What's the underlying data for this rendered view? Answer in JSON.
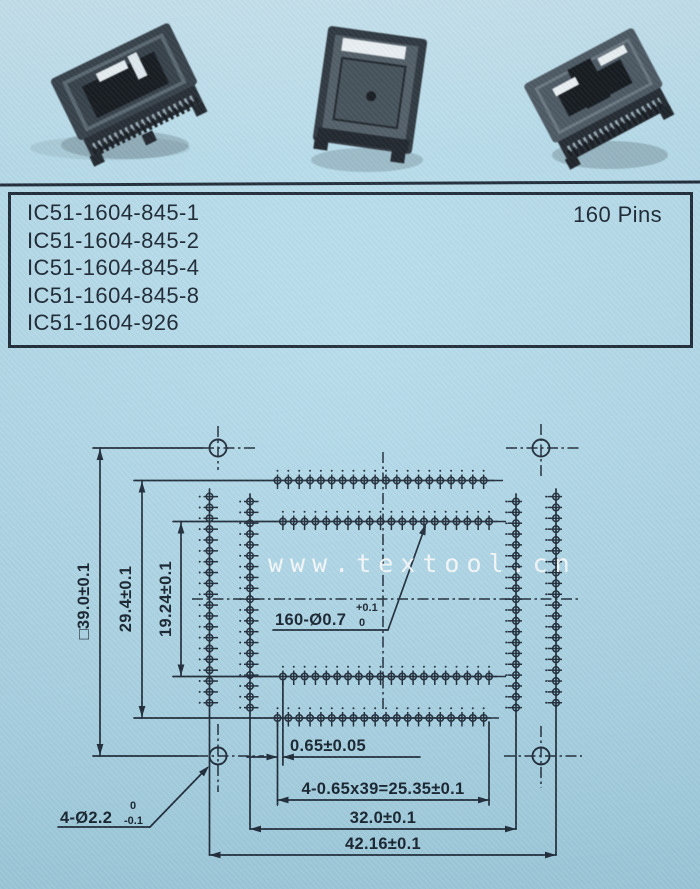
{
  "page": {
    "bg_color": "#b4dbea",
    "ink_color": "#1c2836",
    "description": "Scanned catalog page for 160-pin IC sockets with product photos, part list and dimensioned footprint drawing"
  },
  "photos": {
    "count": 3,
    "items": [
      {
        "label": "ic-socket-photo-left"
      },
      {
        "label": "ic-socket-photo-center"
      },
      {
        "label": "ic-socket-photo-right"
      }
    ]
  },
  "parts_panel": {
    "part_numbers": [
      "IC51-1604-845-1",
      "IC51-1604-845-2",
      "IC51-1604-845-4",
      "IC51-1604-845-8",
      "IC51-1604-926"
    ],
    "pins_label": "160 Pins"
  },
  "watermark": {
    "text": "www.textool.cn",
    "color": "#ffffff"
  },
  "drawing": {
    "dimensions": {
      "outline_square": "□39.0±0.1",
      "outer_rows": "29.4±0.1",
      "inner_rows": "19.24±0.1",
      "pitch": "0.65±0.05",
      "row_span": "4-0.65x39=25.35±0.1",
      "inner_cols": "32.0±0.1",
      "outer_cols": "42.16±0.1",
      "pin_hole": {
        "label": "160-Ø0.7",
        "tol_upper": "+0.1",
        "tol_lower": "0"
      },
      "mount_hole": {
        "label": "4-Ø2.2",
        "tol_upper": "0",
        "tol_lower": "-0.1"
      }
    },
    "pins": {
      "total": 160,
      "per_side": 40,
      "per_row": 20,
      "rows": 8
    },
    "mount_holes": 4
  }
}
